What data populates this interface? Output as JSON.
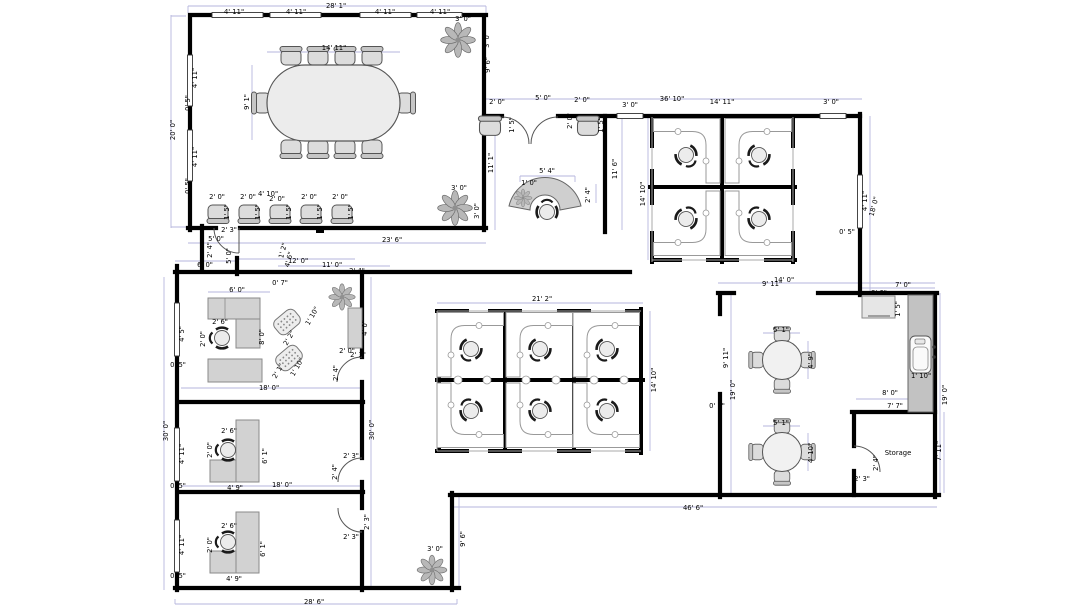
{
  "plan": {
    "visible_room_labels": [
      "Storage"
    ],
    "palette": {
      "wall": "#000000",
      "dimension_guide": "#b6b6dd",
      "furniture_fill": "#d2d2d2",
      "counter_fill": "#c2c2c2",
      "desk_outline": "#999999",
      "plant_fill": "#b8b8b8",
      "background": "#ffffff"
    }
  },
  "dimension_labels": [
    {
      "t": "28' 1\"",
      "x": 336,
      "y": 8
    },
    {
      "t": "4' 11\"",
      "x": 234,
      "y": 14
    },
    {
      "t": "4' 11\"",
      "x": 296,
      "y": 14
    },
    {
      "t": "4' 11\"",
      "x": 385,
      "y": 14
    },
    {
      "t": "4' 11\"",
      "x": 440,
      "y": 14
    },
    {
      "t": "3' 0\"",
      "x": 463,
      "y": 21
    },
    {
      "t": "3' 0\"",
      "x": 489,
      "y": 40,
      "r": -90
    },
    {
      "t": "20' 0\"",
      "x": 175,
      "y": 130,
      "r": -90
    },
    {
      "t": "4' 11\"",
      "x": 197,
      "y": 78,
      "r": -90
    },
    {
      "t": "0' 5\"",
      "x": 190,
      "y": 103,
      "r": -90
    },
    {
      "t": "4' 11\"",
      "x": 197,
      "y": 157,
      "r": -90
    },
    {
      "t": "0' 5\"",
      "x": 190,
      "y": 186,
      "r": -90
    },
    {
      "t": "14' 11\"",
      "x": 334,
      "y": 50
    },
    {
      "t": "9' 1\"",
      "x": 249,
      "y": 102,
      "r": -90
    },
    {
      "t": "3' 0\"",
      "x": 459,
      "y": 190
    },
    {
      "t": "3' 0\"",
      "x": 479,
      "y": 211,
      "r": -90
    },
    {
      "t": "9' 6\"",
      "x": 490,
      "y": 65,
      "r": -90
    },
    {
      "t": "2' 0\"",
      "x": 217,
      "y": 199
    },
    {
      "t": "2' 0\"",
      "x": 248,
      "y": 199
    },
    {
      "t": "4' 10\"",
      "x": 268,
      "y": 196
    },
    {
      "t": "2' 0\"",
      "x": 277,
      "y": 201
    },
    {
      "t": "2' 0\"",
      "x": 309,
      "y": 199
    },
    {
      "t": "2' 0\"",
      "x": 340,
      "y": 199
    },
    {
      "t": "1' 5\"",
      "x": 229,
      "y": 212,
      "r": -90
    },
    {
      "t": "1' 5\"",
      "x": 260,
      "y": 212,
      "r": -90
    },
    {
      "t": "1' 5\"",
      "x": 291,
      "y": 212,
      "r": -90
    },
    {
      "t": "1' 5\"",
      "x": 322,
      "y": 212,
      "r": -90
    },
    {
      "t": "1' 5\"",
      "x": 353,
      "y": 212,
      "r": -90
    },
    {
      "t": "23' 6\"",
      "x": 392,
      "y": 242
    },
    {
      "t": "2' 3\"",
      "x": 229,
      "y": 232
    },
    {
      "t": "2' 4\"",
      "x": 212,
      "y": 250,
      "r": -90
    },
    {
      "t": "5' 0\"",
      "x": 216,
      "y": 241
    },
    {
      "t": "5' 0\"",
      "x": 231,
      "y": 256,
      "r": -90
    },
    {
      "t": "1' 2\"",
      "x": 285,
      "y": 251,
      "r": -75
    },
    {
      "t": "4' 6\"",
      "x": 291,
      "y": 260,
      "r": -75
    },
    {
      "t": "6' 0\"",
      "x": 205,
      "y": 267
    },
    {
      "t": "12' 0\"",
      "x": 298,
      "y": 263
    },
    {
      "t": "11' 0\"",
      "x": 332,
      "y": 267
    },
    {
      "t": "2' 4\"",
      "x": 357,
      "y": 273
    },
    {
      "t": "0' 7\"",
      "x": 280,
      "y": 285
    },
    {
      "t": "2' 0\"",
      "x": 497,
      "y": 104
    },
    {
      "t": "5' 0\"",
      "x": 543,
      "y": 100
    },
    {
      "t": "2' 0\"",
      "x": 582,
      "y": 102
    },
    {
      "t": "3' 0\"",
      "x": 630,
      "y": 107
    },
    {
      "t": "11' 1\"",
      "x": 493,
      "y": 163,
      "r": -90
    },
    {
      "t": "1' 5\"",
      "x": 514,
      "y": 125,
      "r": -90
    },
    {
      "t": "2' 0\"",
      "x": 572,
      "y": 121,
      "r": -90
    },
    {
      "t": "1' 5\"",
      "x": 603,
      "y": 125,
      "r": -90
    },
    {
      "t": "5' 4\"",
      "x": 547,
      "y": 173
    },
    {
      "t": "1' 0\"",
      "x": 529,
      "y": 185
    },
    {
      "t": "2' 4\"",
      "x": 590,
      "y": 195,
      "r": -90
    },
    {
      "t": "11' 6\"",
      "x": 617,
      "y": 169,
      "r": -90
    },
    {
      "t": "36' 10\"",
      "x": 672,
      "y": 101
    },
    {
      "t": "14' 11\"",
      "x": 722,
      "y": 104
    },
    {
      "t": "3' 0\"",
      "x": 831,
      "y": 104
    },
    {
      "t": "14' 10\"",
      "x": 645,
      "y": 194,
      "r": -90
    },
    {
      "t": "4' 11\"",
      "x": 867,
      "y": 201,
      "r": -90
    },
    {
      "t": "18' 0\"",
      "x": 876,
      "y": 207,
      "r": -75
    },
    {
      "t": "0' 5\"",
      "x": 847,
      "y": 234
    },
    {
      "t": "14' 0\"",
      "x": 784,
      "y": 282
    },
    {
      "t": "9' 11\"",
      "x": 772,
      "y": 286
    },
    {
      "t": "7' 0\"",
      "x": 903,
      "y": 287
    },
    {
      "t": "3' 0\"",
      "x": 879,
      "y": 295
    },
    {
      "t": "1' 5\"",
      "x": 900,
      "y": 309,
      "r": -90
    },
    {
      "t": "9' 11\"",
      "x": 728,
      "y": 358,
      "r": -90
    },
    {
      "t": "19' 0\"",
      "x": 735,
      "y": 390,
      "r": -90
    },
    {
      "t": "0' 7\"",
      "x": 717,
      "y": 408
    },
    {
      "t": "5' 1\"",
      "x": 781,
      "y": 332
    },
    {
      "t": "4' 9\"",
      "x": 813,
      "y": 361,
      "r": -90
    },
    {
      "t": "5' 1\"",
      "x": 781,
      "y": 425
    },
    {
      "t": "4' 10\"",
      "x": 813,
      "y": 453,
      "r": -90
    },
    {
      "t": "1' 10\"",
      "x": 921,
      "y": 378
    },
    {
      "t": "19' 0\"",
      "x": 947,
      "y": 395,
      "r": -90
    },
    {
      "t": "8' 0\"",
      "x": 890,
      "y": 395
    },
    {
      "t": "7' 7\"",
      "x": 895,
      "y": 408
    },
    {
      "t": "Storage",
      "x": 898,
      "y": 455
    },
    {
      "t": "2' 3\"",
      "x": 862,
      "y": 481
    },
    {
      "t": "2' 4\"",
      "x": 878,
      "y": 463,
      "r": -90
    },
    {
      "t": "7' 11\"",
      "x": 941,
      "y": 451,
      "r": -90
    },
    {
      "t": "21' 2\"",
      "x": 542,
      "y": 301
    },
    {
      "t": "14' 10\"",
      "x": 656,
      "y": 380,
      "r": -90
    },
    {
      "t": "6' 0\"",
      "x": 237,
      "y": 292
    },
    {
      "t": "2' 6\"",
      "x": 220,
      "y": 324
    },
    {
      "t": "2' 0\"",
      "x": 205,
      "y": 339,
      "r": -90
    },
    {
      "t": "8' 0\"",
      "x": 264,
      "y": 337,
      "r": -90
    },
    {
      "t": "4' 5\"",
      "x": 184,
      "y": 334,
      "r": -90
    },
    {
      "t": "0' 5\"",
      "x": 178,
      "y": 367
    },
    {
      "t": "1' 10\"",
      "x": 314,
      "y": 317,
      "r": -60
    },
    {
      "t": "2' 2\"",
      "x": 291,
      "y": 339,
      "r": -60
    },
    {
      "t": "2' 1\"",
      "x": 280,
      "y": 372,
      "r": -60
    },
    {
      "t": "1' 10\"",
      "x": 299,
      "y": 368,
      "r": -60
    },
    {
      "t": "4' 0\"",
      "x": 367,
      "y": 328,
      "r": -90
    },
    {
      "t": "2' 0\"",
      "x": 347,
      "y": 353
    },
    {
      "t": "2' 3\"",
      "x": 358,
      "y": 357
    },
    {
      "t": "2' 4\"",
      "x": 338,
      "y": 373,
      "r": -90
    },
    {
      "t": "18' 0\"",
      "x": 269,
      "y": 390
    },
    {
      "t": "30' 0\"",
      "x": 168,
      "y": 431,
      "r": -90
    },
    {
      "t": "30' 0\"",
      "x": 374,
      "y": 430,
      "r": -90
    },
    {
      "t": "2' 6\"",
      "x": 229,
      "y": 433
    },
    {
      "t": "2' 0\"",
      "x": 212,
      "y": 450,
      "r": -90
    },
    {
      "t": "6' 1\"",
      "x": 267,
      "y": 456,
      "r": -90
    },
    {
      "t": "4' 9\"",
      "x": 235,
      "y": 490
    },
    {
      "t": "18' 0\"",
      "x": 282,
      "y": 487
    },
    {
      "t": "4' 11\"",
      "x": 184,
      "y": 454,
      "r": -90
    },
    {
      "t": "0' 5\"",
      "x": 178,
      "y": 488
    },
    {
      "t": "2' 3\"",
      "x": 351,
      "y": 458
    },
    {
      "t": "2' 4\"",
      "x": 337,
      "y": 472,
      "r": -90
    },
    {
      "t": "2' 6\"",
      "x": 229,
      "y": 528
    },
    {
      "t": "2' 0\"",
      "x": 212,
      "y": 545,
      "r": -90
    },
    {
      "t": "6' 1\"",
      "x": 265,
      "y": 549,
      "r": -90
    },
    {
      "t": "4' 9\"",
      "x": 234,
      "y": 581
    },
    {
      "t": "4' 11\"",
      "x": 184,
      "y": 545,
      "r": -90
    },
    {
      "t": "0' 5\"",
      "x": 178,
      "y": 578
    },
    {
      "t": "2' 3\"",
      "x": 369,
      "y": 522,
      "r": -90
    },
    {
      "t": "2' 3\"",
      "x": 351,
      "y": 539
    },
    {
      "t": "28' 6\"",
      "x": 314,
      "y": 604
    },
    {
      "t": "46' 6\"",
      "x": 693,
      "y": 510
    },
    {
      "t": "9' 6\"",
      "x": 465,
      "y": 539,
      "r": -90
    },
    {
      "t": "3' 0\"",
      "x": 435,
      "y": 551
    }
  ]
}
